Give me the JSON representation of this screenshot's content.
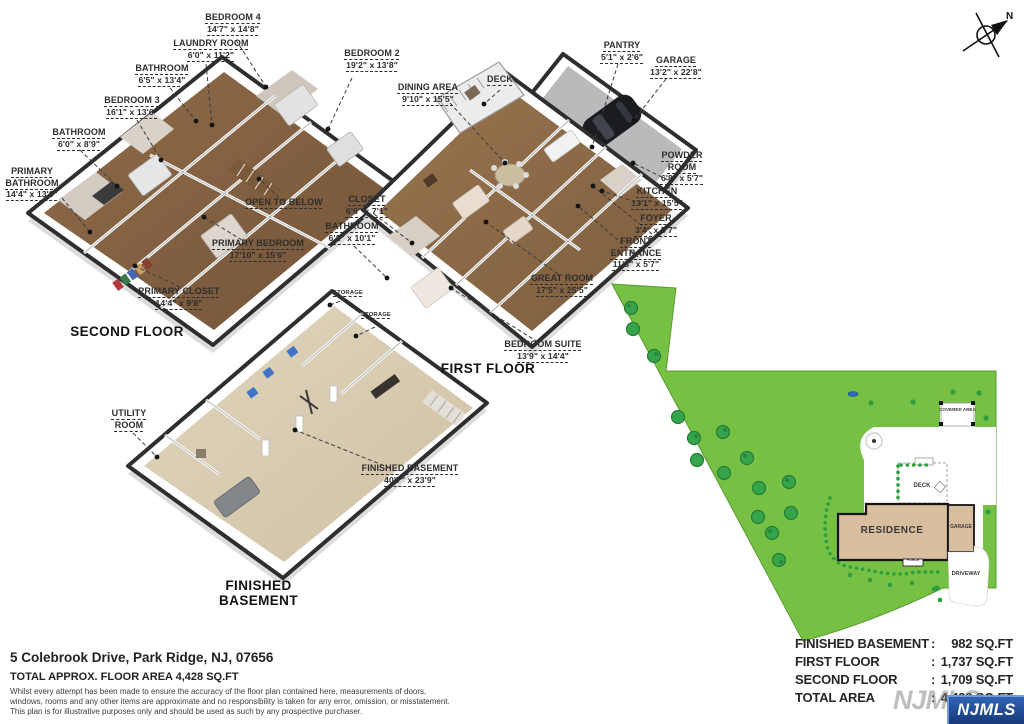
{
  "floors": {
    "second": {
      "title": "SECOND FLOOR",
      "labels": [
        {
          "name": "BEDROOM 4",
          "dims": "14'7\" x 14'8\""
        },
        {
          "name": "LAUNDRY ROOM",
          "dims": "6'0\" x 11'2\""
        },
        {
          "name": "BATHROOM",
          "dims": "6'5\" x 13'4\""
        },
        {
          "name": "BEDROOM 3",
          "dims": "16'1\" x 13'6\""
        },
        {
          "name": "BATHROOM",
          "dims": "6'0\" x 8'9\""
        },
        {
          "name": "PRIMARY BATHROOM",
          "dims": "14'4\" x 13'0\""
        },
        {
          "name": "BEDROOM 2",
          "dims": "19'2\" x 13'8\""
        },
        {
          "name": "OPEN TO BELOW"
        },
        {
          "name": "PRIMARY BEDROOM",
          "dims": "17'10\" x 15'6\""
        },
        {
          "name": "PRIMARY CLOSET",
          "dims": "14'4\" x 9'8\""
        }
      ]
    },
    "first": {
      "title": "FIRST FLOOR",
      "labels": [
        {
          "name": "CLOSET",
          "dims": "6'6\" x 7'1\""
        },
        {
          "name": "BATHROOM",
          "dims": "6'2\" x 10'1\""
        },
        {
          "name": "PANTRY",
          "dims": "5'1\" x 2'6\""
        },
        {
          "name": "GARAGE",
          "dims": "13'2\" x 22'8\""
        },
        {
          "name": "DECK"
        },
        {
          "name": "DINING AREA",
          "dims": "9'10\" x 15'5\""
        },
        {
          "name": "POWDER ROOM",
          "dims": "6'8\" x 5'7\""
        },
        {
          "name": "KITCHEN",
          "dims": "13'1\" x 15'5\""
        },
        {
          "name": "FOYER",
          "dims": "3'4\" x 5'7\""
        },
        {
          "name": "FRONT ENTRANCE",
          "dims": "11'8\" x 5'7\""
        },
        {
          "name": "GREAT ROOM",
          "dims": "17'5\" x 25'5\""
        },
        {
          "name": "BEDROOM SUITE",
          "dims": "13'9\" x 14'4\""
        }
      ]
    },
    "basement": {
      "title": "FINISHED BASEMENT",
      "labels": [
        {
          "name": "UTILITY ROOM"
        },
        {
          "name": "FINISHED BASEMENT",
          "dims": "40'7\" x 23'9\""
        },
        {
          "name": "STORAGE"
        },
        {
          "name": "STORAGE"
        }
      ]
    }
  },
  "site_plan": {
    "residence": "RESIDENCE",
    "garage": "GARAGE",
    "deck": "DECK",
    "driveway": "DRIVEWAY",
    "porch": "PORCH",
    "covered_area": "COVERED AREA",
    "compass": "N"
  },
  "summary": {
    "separator": ":",
    "rows": [
      {
        "label": "FINISHED BASEMENT",
        "value": "982 SQ.FT"
      },
      {
        "label": "FIRST FLOOR",
        "value": "1,737 SQ.FT"
      },
      {
        "label": "SECOND FLOOR",
        "value": "1,709 SQ.FT"
      },
      {
        "label": "TOTAL AREA",
        "value": "4,428 SQ.FT"
      }
    ],
    "watermark": "NJMLS"
  },
  "logo": {
    "text": "NJMLS"
  },
  "footer": {
    "address": "5 Colebrook Drive, Park Ridge, NJ, 07656",
    "total_line": "TOTAL APPROX. FLOOR AREA 4,428 SQ.FT",
    "disclaimer": {
      "line1": "Whilst every attempt has been made to ensure the accuracy of the floor plan contained here, measurements of doors,",
      "line2": "windows, rooms and any other items are approximate and no responsibility is taken for any error, omission, or misstatement.",
      "line3": "This plan is for illustrative purposes only and should be used as such by any prospective purchaser."
    }
  },
  "colors": {
    "lot_green": "#76c043",
    "tree_green": "#2f9e41",
    "residence_tan": "#d9bd9f",
    "wall_dark": "#2e2e2e",
    "wood_floor": "#8a6747",
    "basement_floor": "#d9ccb2",
    "logo_blue": "#2f64b4"
  }
}
